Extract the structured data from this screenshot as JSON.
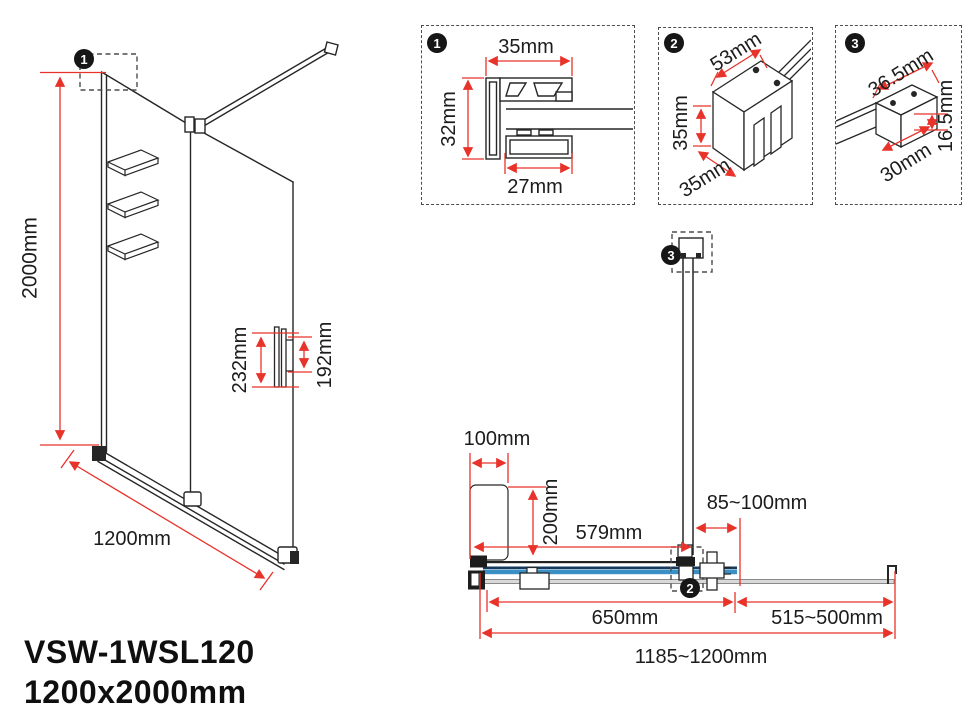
{
  "product": {
    "model": "VSW-1WSL120",
    "size": "1200x2000mm"
  },
  "colors": {
    "dimension_red": "#e8332a",
    "line_black": "#262626",
    "glass_blue": "#3a8fc4",
    "glass_navy": "#17395c",
    "glass_gray": "#d9d9d9"
  },
  "front_view": {
    "marker": "1",
    "height": "2000mm",
    "width": "1200mm",
    "handle_outer": "232mm",
    "handle_inner": "192mm"
  },
  "detail_boxes": [
    {
      "marker": "1",
      "top": "35mm",
      "left": "32mm",
      "bottom": "27mm"
    },
    {
      "marker": "2",
      "top": "53mm",
      "left": "35mm",
      "bottom": "35mm"
    },
    {
      "marker": "3",
      "top": "36.5mm",
      "right": "16.5mm",
      "bottom": "30mm"
    }
  ],
  "plan_view": {
    "marker_wall_bracket": "3",
    "marker_bar_clamp": "2",
    "fixed_zone_width": "100mm",
    "fixed_zone_depth": "200mm",
    "bar_position": "579mm",
    "bar_to_edge": "85~100mm",
    "fixed_panel_width": "650mm",
    "second_panel_width": "515~500mm",
    "total_width": "1185~1200mm"
  }
}
